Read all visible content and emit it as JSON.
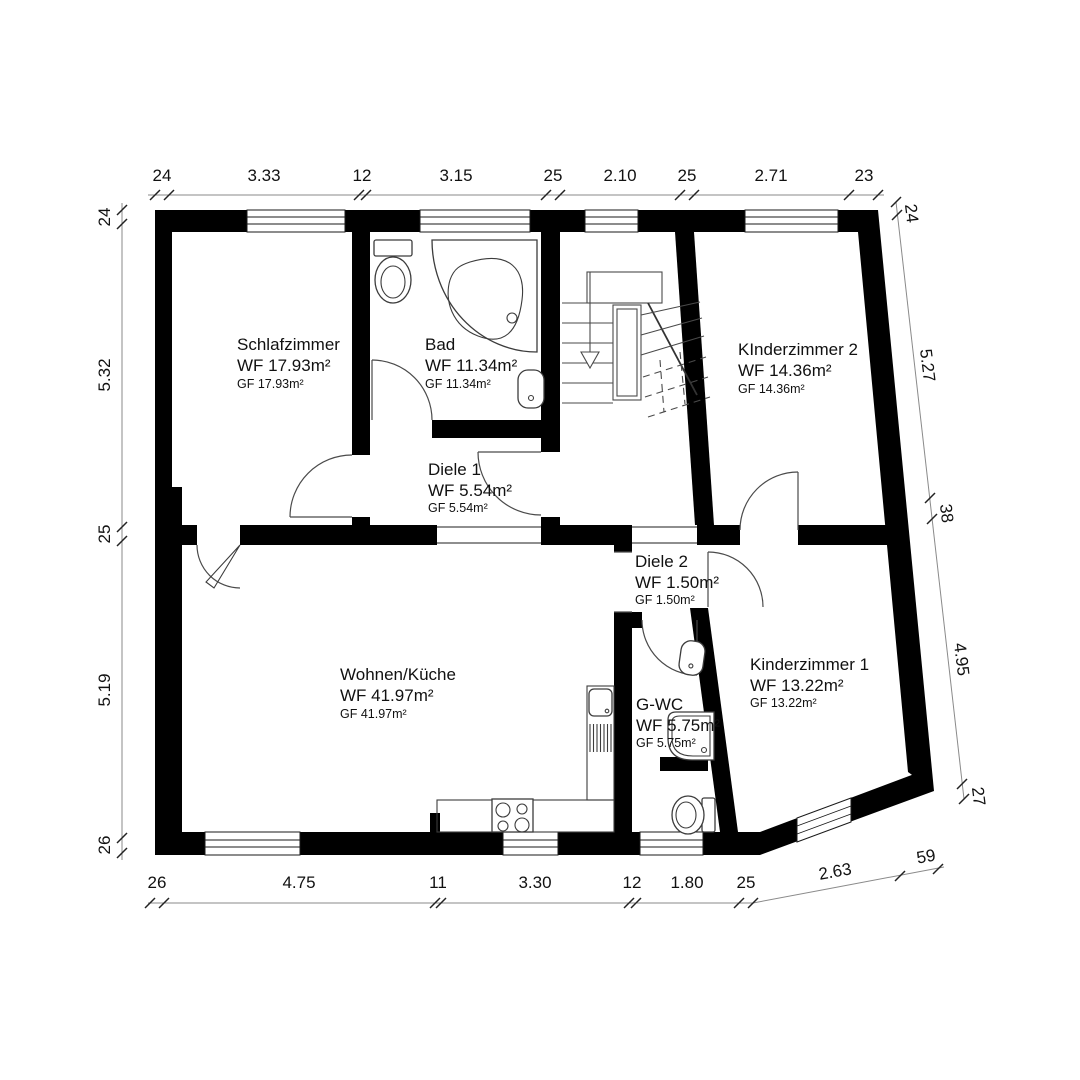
{
  "plan": {
    "type_label": "floor-plan",
    "rooms": [
      {
        "name": "Schlafzimmer",
        "wf": "WF 17.93m²",
        "gf": "GF 17.93m²"
      },
      {
        "name": "Bad",
        "wf": "WF 11.34m²",
        "gf": "GF 11.34m²"
      },
      {
        "name": "KInderzimmer 2",
        "wf": "WF 14.36m²",
        "gf": "GF 14.36m²"
      },
      {
        "name": "Diele 1",
        "wf": "WF 5.54m²",
        "gf": "GF 5.54m²"
      },
      {
        "name": "Diele 2",
        "wf": "WF 1.50m²",
        "gf": "GF 1.50m²"
      },
      {
        "name": "Wohnen/Küche",
        "wf": "WF 41.97m²",
        "gf": "GF 41.97m²"
      },
      {
        "name": "G-WC",
        "wf": "WF 5.75m²",
        "gf": "GF 5.75m²"
      },
      {
        "name": "Kinderzimmer 1",
        "wf": "WF 13.22m²",
        "gf": "GF 13.22m²"
      }
    ],
    "dimensions": {
      "top": [
        "24",
        "3.33",
        "12",
        "3.15",
        "25",
        "2.10",
        "25",
        "2.71",
        "23"
      ],
      "left": [
        "24",
        "5.32",
        "25",
        "5.19",
        "26"
      ],
      "right": [
        "24",
        "5.27",
        "38",
        "4.95",
        "27"
      ],
      "bottom": [
        "26",
        "4.75",
        "11",
        "3.30",
        "12",
        "1.80",
        "25",
        "2.63",
        "59"
      ]
    },
    "colors": {
      "wall": "#000000",
      "background": "#ffffff",
      "dimension_line": "#8a8a8a"
    }
  }
}
